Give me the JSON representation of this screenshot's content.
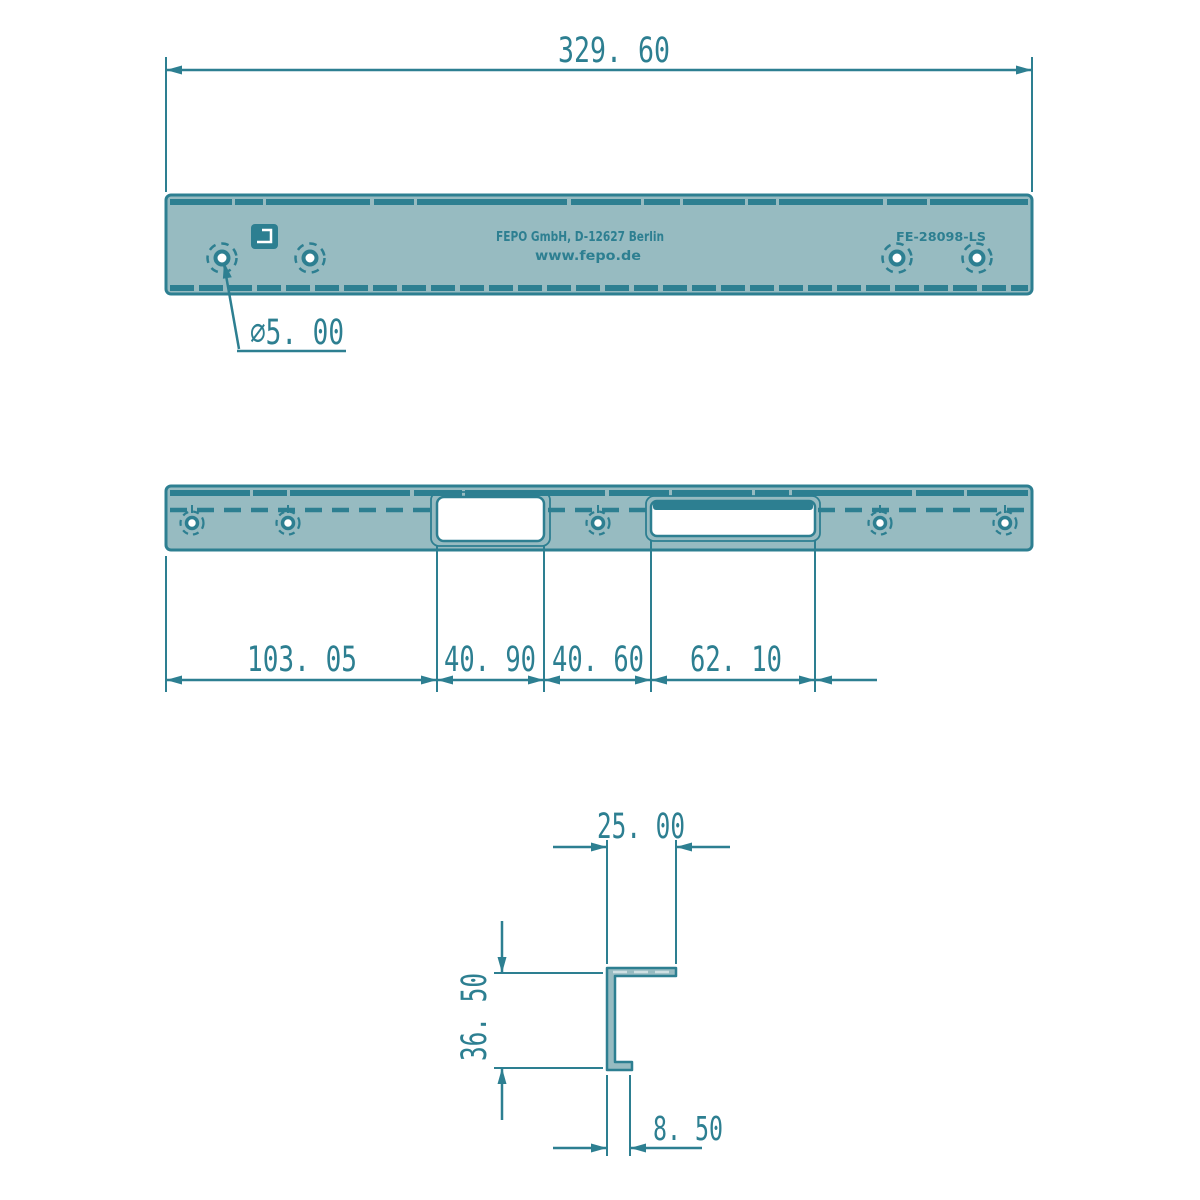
{
  "drawing": {
    "colors": {
      "line": "#2d7f91",
      "part_fill": "#97bbc1",
      "cutout_fill": "#ffffff",
      "background": "#ffffff"
    },
    "top_view": {
      "overall_width": "329. 60",
      "hole_diameter": "⌀5. 00",
      "stamp_line1": "FEPO GmbH, D-12627 Berlin",
      "stamp_line2": "www.fepo.de",
      "part_number": "FE-28098-LS"
    },
    "front_view": {
      "dims": {
        "left_offset": "103. 05",
        "cutout1_width": "40. 90",
        "gap_width": "40. 60",
        "cutout2_width": "62. 10"
      }
    },
    "profile_view": {
      "top_width": "25. 00",
      "height": "36. 50",
      "flange": "8. 50"
    }
  }
}
